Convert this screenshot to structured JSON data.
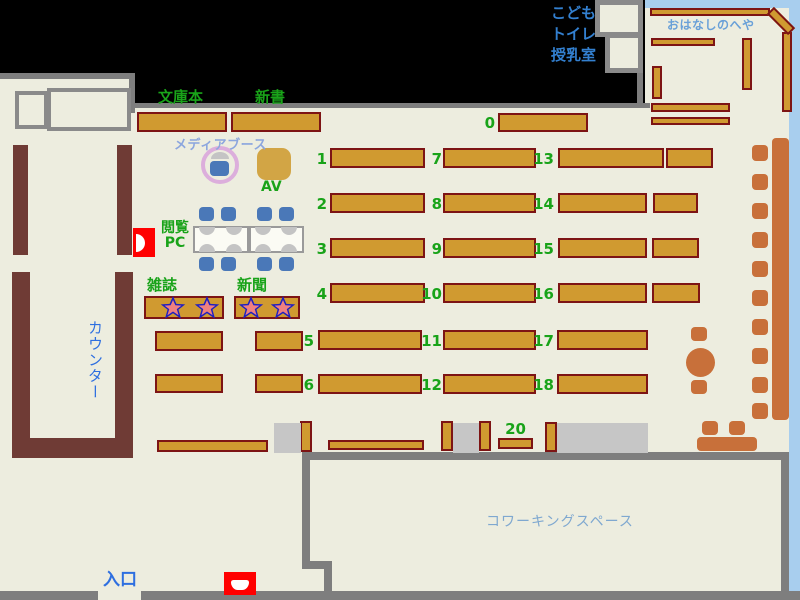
{
  "labels": {
    "bunkobon": "文庫本",
    "shinsho": "新書",
    "media_booth": "メディアブース",
    "av": "AV",
    "etsuran_line1": "閲覧",
    "etsuran_line2": "PC",
    "zasshi": "雑誌",
    "shinbun": "新聞",
    "counter": "カウンター",
    "entrance": "入口",
    "coworking": "コワーキングスペース",
    "kids": "こども",
    "toilet": "トイレ",
    "nursing": "授乳室",
    "story_room": "おはなしのへや"
  },
  "colors": {
    "floor": "#EDEDDF",
    "wall_gray": "#7E7E7E",
    "blue_wall": "#A8CEEE",
    "shelf_fill": "#D09A30",
    "shelf_border": "#7D1414",
    "counter_brown": "#6F3B35",
    "furniture_sienna": "#C8703A",
    "seat_blue": "#4A78B8",
    "label_green": "#19A319",
    "label_blue": "#2E6FE0",
    "label_blue2": "#3380D0",
    "label_lightblue": "#8CA6DE",
    "story_label": "#69A0D8",
    "coworking_label": "#7FA8D0",
    "star_fill": "#F08080",
    "star_border": "#2020C0",
    "alert_red": "#FF0000",
    "circle_border": "#DCAEDC",
    "gray_table": "#C6C6C6",
    "monitor_gray": "#C4C4C4"
  },
  "plan": {
    "shelves": {
      "plain": [
        [
          137,
          112,
          90,
          20
        ],
        [
          231,
          112,
          90,
          20
        ],
        [
          155,
          331,
          68,
          20
        ],
        [
          255,
          331,
          48,
          20
        ],
        [
          155,
          374,
          68,
          19
        ],
        [
          255,
          374,
          48,
          19
        ],
        [
          157,
          440,
          111,
          12
        ],
        [
          328,
          440,
          96,
          10
        ],
        [
          300,
          421,
          12,
          31
        ],
        [
          441,
          421,
          12,
          30
        ],
        [
          479,
          421,
          12,
          30
        ],
        [
          545,
          422,
          12,
          30
        ]
      ],
      "story": [
        [
          650,
          8,
          120,
          8
        ],
        [
          651,
          38,
          64,
          8
        ],
        [
          652,
          66,
          10,
          33
        ],
        [
          742,
          38,
          10,
          52
        ],
        [
          782,
          32,
          10,
          80
        ],
        [
          651,
          103,
          79,
          9
        ],
        [
          651,
          117,
          79,
          8
        ],
        [
          766,
          16,
          30,
          10,
          45
        ]
      ],
      "numbered": [
        {
          "n": "0",
          "label": [
            471,
            113,
            24
          ],
          "rects": [
            [
              498,
              113,
              90,
              19
            ]
          ]
        },
        {
          "n": "1",
          "label": [
            303,
            149,
            24
          ],
          "rects": [
            [
              330,
              148,
              95,
              20
            ]
          ]
        },
        {
          "n": "2",
          "label": [
            303,
            194,
            24
          ],
          "rects": [
            [
              330,
              193,
              95,
              20
            ]
          ]
        },
        {
          "n": "3",
          "label": [
            303,
            239,
            24
          ],
          "rects": [
            [
              330,
              238,
              95,
              20
            ]
          ]
        },
        {
          "n": "4",
          "label": [
            303,
            284,
            24
          ],
          "rects": [
            [
              330,
              283,
              95,
              20
            ]
          ]
        },
        {
          "n": "5",
          "label": [
            290,
            331,
            24
          ],
          "rects": [
            [
              318,
              330,
              104,
              20
            ]
          ]
        },
        {
          "n": "6",
          "label": [
            290,
            375,
            24
          ],
          "rects": [
            [
              318,
              374,
              104,
              20
            ]
          ]
        },
        {
          "n": "7",
          "label": [
            418,
            149,
            24
          ],
          "rects": [
            [
              443,
              148,
              93,
              20
            ]
          ]
        },
        {
          "n": "8",
          "label": [
            418,
            194,
            24
          ],
          "rects": [
            [
              443,
              193,
              93,
              20
            ]
          ]
        },
        {
          "n": "9",
          "label": [
            418,
            239,
            24
          ],
          "rects": [
            [
              443,
              238,
              93,
              20
            ]
          ]
        },
        {
          "n": "10",
          "label": [
            414,
            284,
            28
          ],
          "rects": [
            [
              443,
              283,
              93,
              20
            ]
          ]
        },
        {
          "n": "11",
          "label": [
            414,
            331,
            28
          ],
          "rects": [
            [
              443,
              330,
              93,
              20
            ]
          ]
        },
        {
          "n": "12",
          "label": [
            414,
            375,
            28
          ],
          "rects": [
            [
              443,
              374,
              93,
              20
            ]
          ]
        },
        {
          "n": "13",
          "label": [
            526,
            149,
            28
          ],
          "rects": [
            [
              558,
              148,
              106,
              20
            ],
            [
              666,
              148,
              47,
              20
            ]
          ]
        },
        {
          "n": "14",
          "label": [
            526,
            194,
            28
          ],
          "rects": [
            [
              558,
              193,
              89,
              20
            ],
            [
              653,
              193,
              45,
              20
            ]
          ]
        },
        {
          "n": "15",
          "label": [
            526,
            239,
            28
          ],
          "rects": [
            [
              558,
              238,
              89,
              20
            ],
            [
              652,
              238,
              47,
              20
            ]
          ]
        },
        {
          "n": "16",
          "label": [
            526,
            284,
            28
          ],
          "rects": [
            [
              558,
              283,
              89,
              20
            ],
            [
              652,
              283,
              48,
              20
            ]
          ]
        },
        {
          "n": "17",
          "label": [
            526,
            331,
            28
          ],
          "rects": [
            [
              557,
              330,
              91,
              20
            ]
          ]
        },
        {
          "n": "18",
          "label": [
            526,
            375,
            28
          ],
          "rects": [
            [
              557,
              374,
              91,
              20
            ]
          ]
        },
        {
          "n": "20",
          "label": [
            498,
            419,
            35
          ],
          "center": true,
          "rects": [
            [
              498,
              438,
              35,
              11
            ]
          ]
        }
      ]
    },
    "star_shelves": [
      {
        "x": 144,
        "y": 296,
        "w": 80,
        "h": 23,
        "stars": [
          [
            173,
            308
          ],
          [
            207,
            308
          ]
        ]
      },
      {
        "x": 234,
        "y": 296,
        "w": 66,
        "h": 23,
        "stars": [
          [
            251,
            308
          ],
          [
            283,
            308
          ]
        ]
      }
    ],
    "gray_tables": [
      [
        274,
        423,
        27,
        30
      ],
      [
        453,
        423,
        26,
        30
      ],
      [
        557,
        423,
        91,
        30
      ]
    ],
    "furniture": {
      "bench": [
        772,
        138,
        17,
        282
      ],
      "round_table": [
        686,
        348,
        29,
        29
      ],
      "sofa_table": [
        697,
        437,
        60,
        14
      ],
      "stools": [
        [
          752,
          145,
          16,
          16
        ],
        [
          752,
          174,
          16,
          16
        ],
        [
          752,
          203,
          16,
          16
        ],
        [
          752,
          232,
          16,
          16
        ],
        [
          752,
          261,
          16,
          16
        ],
        [
          752,
          290,
          16,
          16
        ],
        [
          752,
          319,
          16,
          16
        ],
        [
          752,
          348,
          16,
          16
        ],
        [
          752,
          377,
          16,
          16
        ],
        [
          752,
          403,
          16,
          16
        ],
        [
          691,
          327,
          16,
          14
        ],
        [
          691,
          380,
          16,
          14
        ],
        [
          702,
          421,
          16,
          14
        ],
        [
          729,
          421,
          16,
          14
        ]
      ]
    },
    "pc": {
      "tables": [
        [
          193,
          226,
          56,
          27
        ],
        [
          249,
          226,
          55,
          27
        ]
      ],
      "chairs": [
        [
          199,
          207,
          15,
          14
        ],
        [
          221,
          207,
          15,
          14
        ],
        [
          257,
          207,
          15,
          14
        ],
        [
          279,
          207,
          15,
          14
        ],
        [
          199,
          257,
          15,
          14
        ],
        [
          221,
          257,
          15,
          14
        ],
        [
          257,
          257,
          15,
          14
        ],
        [
          279,
          257,
          15,
          14
        ]
      ],
      "monitors": [
        [
          199,
          227,
          16,
          8,
          0
        ],
        [
          226,
          227,
          16,
          8,
          0
        ],
        [
          255,
          227,
          16,
          8,
          0
        ],
        [
          281,
          227,
          16,
          8,
          0
        ],
        [
          199,
          244,
          16,
          8,
          1
        ],
        [
          226,
          244,
          16,
          8,
          1
        ],
        [
          255,
          244,
          16,
          8,
          1
        ],
        [
          281,
          244,
          16,
          8,
          1
        ]
      ]
    }
  }
}
